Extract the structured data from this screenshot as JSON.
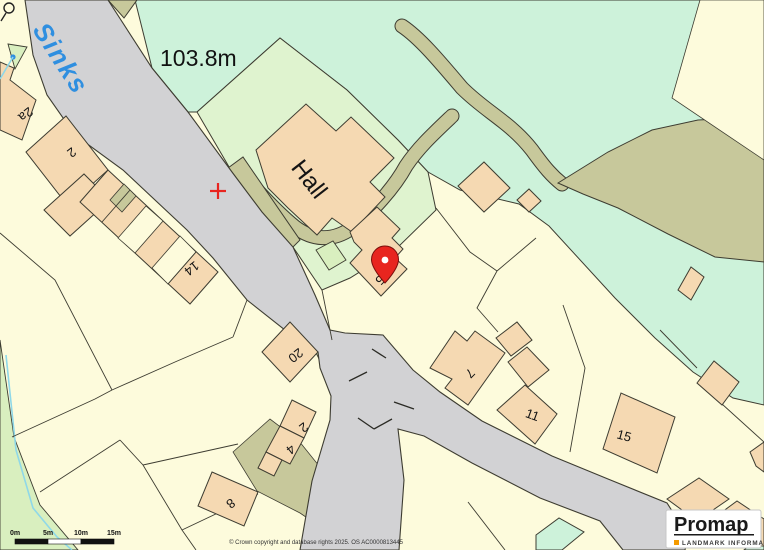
{
  "map": {
    "colors": {
      "parcel": "#fdfbdc",
      "road": "#d2d2d4",
      "building": "#f5d9b2",
      "green_mint": "#cdf2da",
      "green_lawn": "#dff3cf",
      "green_light": "#d9efbf",
      "khaki": "#c7c89b",
      "water": "#8fd8e8",
      "label_blue": "#2f8fe0",
      "marker_red": "#e8251f",
      "outline": "#3d3c31"
    },
    "labels": {
      "water_feature": "Sinks",
      "spot_height": "103.8m",
      "building_name": "Hall"
    },
    "house_numbers": {
      "n2a": "2a",
      "n2": "2",
      "n14": "14",
      "n20": "20",
      "n2b": "2",
      "n4": "4",
      "n8": "8",
      "n5": "5",
      "n7": "7",
      "n11": "11",
      "n15": "15"
    },
    "scale_bar": {
      "labels": [
        "0m",
        "5m",
        "10m",
        "15m"
      ]
    },
    "copyright": "© Crown copyright and database rights 2025. OS AC0000813445",
    "logo": {
      "brand": "Promap",
      "tagline": "LANDMARK INFORMATION"
    }
  }
}
